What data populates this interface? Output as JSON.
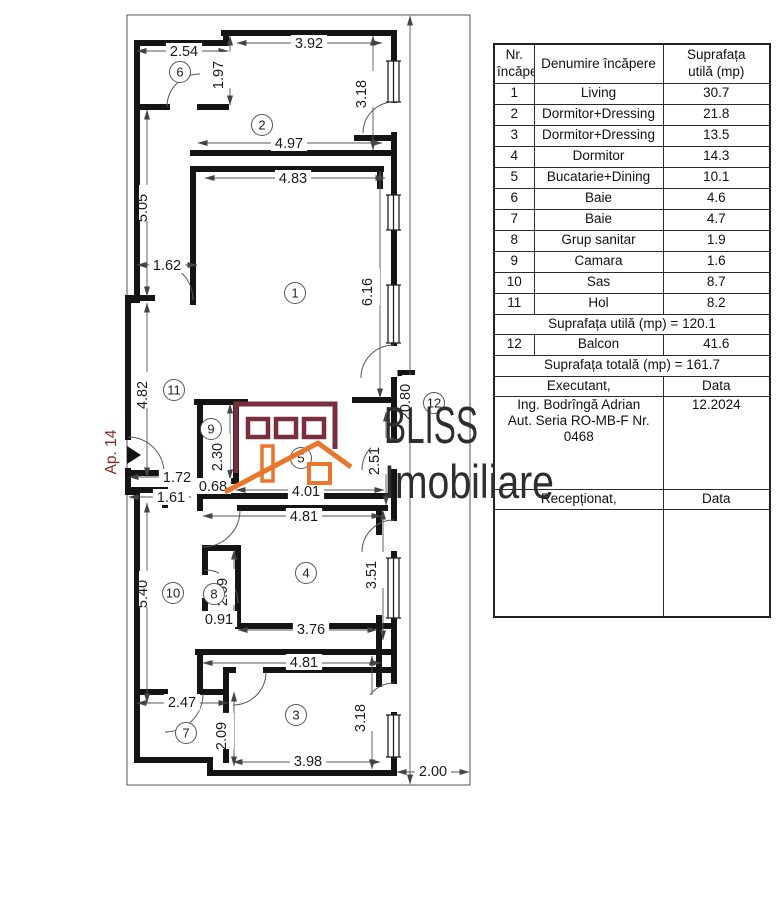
{
  "plan": {
    "apartment_label": "Ap. 14",
    "apartment_label_color": "#8d2525",
    "rooms": [
      {
        "n": "1",
        "x": 295,
        "y": 293
      },
      {
        "n": "2",
        "x": 262,
        "y": 125
      },
      {
        "n": "3",
        "x": 296,
        "y": 715
      },
      {
        "n": "4",
        "x": 306,
        "y": 573
      },
      {
        "n": "5",
        "x": 301,
        "y": 458
      },
      {
        "n": "6",
        "x": 180,
        "y": 72
      },
      {
        "n": "7",
        "x": 186,
        "y": 733
      },
      {
        "n": "8",
        "x": 214,
        "y": 594
      },
      {
        "n": "9",
        "x": 211,
        "y": 429
      },
      {
        "n": "10",
        "x": 173,
        "y": 593
      },
      {
        "n": "11",
        "x": 174,
        "y": 390
      },
      {
        "n": "12",
        "x": 434,
        "y": 403
      }
    ],
    "dimensions": [
      {
        "t": "2.54",
        "x1": 137,
        "y1": 51,
        "x2": 228,
        "y2": 51,
        "lx": 184,
        "ly": 51,
        "o": "h"
      },
      {
        "t": "1.97",
        "x1": 230,
        "y1": 36,
        "x2": 230,
        "y2": 105,
        "lx": 223,
        "ly": 70,
        "o": "v"
      },
      {
        "t": "3.92",
        "x1": 237,
        "y1": 43,
        "x2": 382,
        "y2": 43,
        "lx": 309,
        "ly": 43,
        "o": "h"
      },
      {
        "t": "3.18",
        "x1": 373,
        "y1": 36,
        "x2": 373,
        "y2": 150,
        "lx": 366,
        "ly": 89,
        "o": "v"
      },
      {
        "t": "4.97",
        "x1": 198,
        "y1": 143,
        "x2": 382,
        "y2": 143,
        "lx": 289,
        "ly": 143,
        "o": "h"
      },
      {
        "t": "4.83",
        "x1": 205,
        "y1": 178,
        "x2": 385,
        "y2": 178,
        "lx": 293,
        "ly": 178,
        "o": "h"
      },
      {
        "t": "5.05",
        "x1": 147,
        "y1": 110,
        "x2": 147,
        "y2": 296,
        "lx": 147,
        "ly": 203,
        "o": "v"
      },
      {
        "t": "1.62",
        "x1": 137,
        "y1": 265,
        "x2": 197,
        "y2": 265,
        "lx": 167,
        "ly": 265,
        "o": "h"
      },
      {
        "t": "6.16",
        "x1": 380,
        "y1": 171,
        "x2": 380,
        "y2": 398,
        "lx": 372,
        "ly": 287,
        "o": "v"
      },
      {
        "t": "4.82",
        "x1": 147,
        "y1": 303,
        "x2": 147,
        "y2": 477,
        "lx": 147,
        "ly": 390,
        "o": "v"
      },
      {
        "t": "20.80",
        "x1": 410,
        "y1": 16,
        "x2": 410,
        "y2": 784,
        "lx": 410,
        "ly": 397,
        "o": "v"
      },
      {
        "t": "2.30",
        "x1": 230,
        "y1": 404,
        "x2": 230,
        "y2": 479,
        "lx": 222,
        "ly": 452,
        "o": "v"
      },
      {
        "t": "1.72",
        "x1": 129,
        "y1": 477,
        "x2": 194,
        "y2": 477,
        "lx": 177,
        "ly": 477,
        "o": "h"
      },
      {
        "t": "0.68",
        "x1": 202,
        "y1": 486,
        "x2": 228,
        "y2": 486,
        "lx": 213,
        "ly": 486,
        "o": "h"
      },
      {
        "t": "1.61",
        "x1": 129,
        "y1": 497,
        "x2": 191,
        "y2": 497,
        "lx": 171,
        "ly": 497,
        "o": "h"
      },
      {
        "t": "4.01",
        "x1": 236,
        "y1": 490,
        "x2": 384,
        "y2": 490,
        "lx": 306,
        "ly": 491,
        "o": "h"
      },
      {
        "t": "2.51",
        "x1": 386,
        "y1": 412,
        "x2": 386,
        "y2": 505,
        "lx": 379,
        "ly": 456,
        "o": "v"
      },
      {
        "t": "4.81",
        "x1": 203,
        "y1": 516,
        "x2": 381,
        "y2": 516,
        "lx": 304,
        "ly": 516,
        "o": "h"
      },
      {
        "t": "5.40",
        "x1": 147,
        "y1": 503,
        "x2": 147,
        "y2": 703,
        "lx": 147,
        "ly": 589,
        "o": "v"
      },
      {
        "t": "2.09",
        "x1": 234,
        "y1": 550,
        "x2": 234,
        "y2": 624,
        "lx": 227,
        "ly": 587,
        "o": "v"
      },
      {
        "t": "0.91",
        "x1": 203,
        "y1": 620,
        "x2": 236,
        "y2": 620,
        "lx": 219,
        "ly": 619,
        "o": "h"
      },
      {
        "t": "3.76",
        "x1": 238,
        "y1": 630,
        "x2": 377,
        "y2": 630,
        "lx": 311,
        "ly": 629,
        "o": "h"
      },
      {
        "t": "3.51",
        "x1": 383,
        "y1": 510,
        "x2": 383,
        "y2": 640,
        "lx": 376,
        "ly": 570,
        "o": "v"
      },
      {
        "t": "4.81",
        "x1": 203,
        "y1": 663,
        "x2": 381,
        "y2": 663,
        "lx": 304,
        "ly": 662,
        "o": "h"
      },
      {
        "t": "2.47",
        "x1": 137,
        "y1": 703,
        "x2": 228,
        "y2": 703,
        "lx": 182,
        "ly": 702,
        "o": "h"
      },
      {
        "t": "2.09",
        "x1": 234,
        "y1": 692,
        "x2": 234,
        "y2": 766,
        "lx": 226,
        "ly": 731,
        "o": "v"
      },
      {
        "t": "3.98",
        "x1": 233,
        "y1": 762,
        "x2": 380,
        "y2": 762,
        "lx": 308,
        "ly": 761,
        "o": "h"
      },
      {
        "t": "3.18",
        "x1": 372,
        "y1": 656,
        "x2": 372,
        "y2": 769,
        "lx": 365,
        "ly": 713,
        "o": "v"
      },
      {
        "t": "2.00",
        "x1": 397,
        "y1": 772,
        "x2": 469,
        "y2": 772,
        "lx": 433,
        "ly": 771,
        "o": "h"
      }
    ]
  },
  "logo": {
    "line1": "BLISS",
    "line2": "Imobiliare",
    "text_color": "#2e2e2e",
    "building_color": "#7a2f3f",
    "roof_color": "#e8762b"
  },
  "table": {
    "headers": [
      "Nr.\nîncăpere",
      "Denumire încăpere",
      "Suprafața\nutilă (mp)"
    ],
    "rows": [
      [
        "1",
        "Living",
        "30.7"
      ],
      [
        "2",
        "Dormitor+Dressing",
        "21.8"
      ],
      [
        "3",
        "Dormitor+Dressing",
        "13.5"
      ],
      [
        "4",
        "Dormitor",
        "14.3"
      ],
      [
        "5",
        "Bucatarie+Dining",
        "10.1"
      ],
      [
        "6",
        "Baie",
        "4.6"
      ],
      [
        "7",
        "Baie",
        "4.7"
      ],
      [
        "8",
        "Grup sanitar",
        "1.9"
      ],
      [
        "9",
        "Camara",
        "1.6"
      ],
      [
        "10",
        "Sas",
        "8.7"
      ],
      [
        "11",
        "Hol",
        "8.2"
      ]
    ],
    "useful_total": "Suprafața utilă (mp) = 120.1",
    "balcony_row": [
      "12",
      "Balcon",
      "41.6"
    ],
    "grand_total": "Suprafața totală (mp) = 161.7",
    "executant_label": "Executant,",
    "data_label": "Data",
    "executant_lines": [
      "Ing. Bodrîngă Adrian",
      "Aut. Seria RO-MB-F Nr. 0468"
    ],
    "date_value": "12.2024",
    "receptionat_label": "Recepționat,",
    "receptionat_data_label": "Data"
  }
}
